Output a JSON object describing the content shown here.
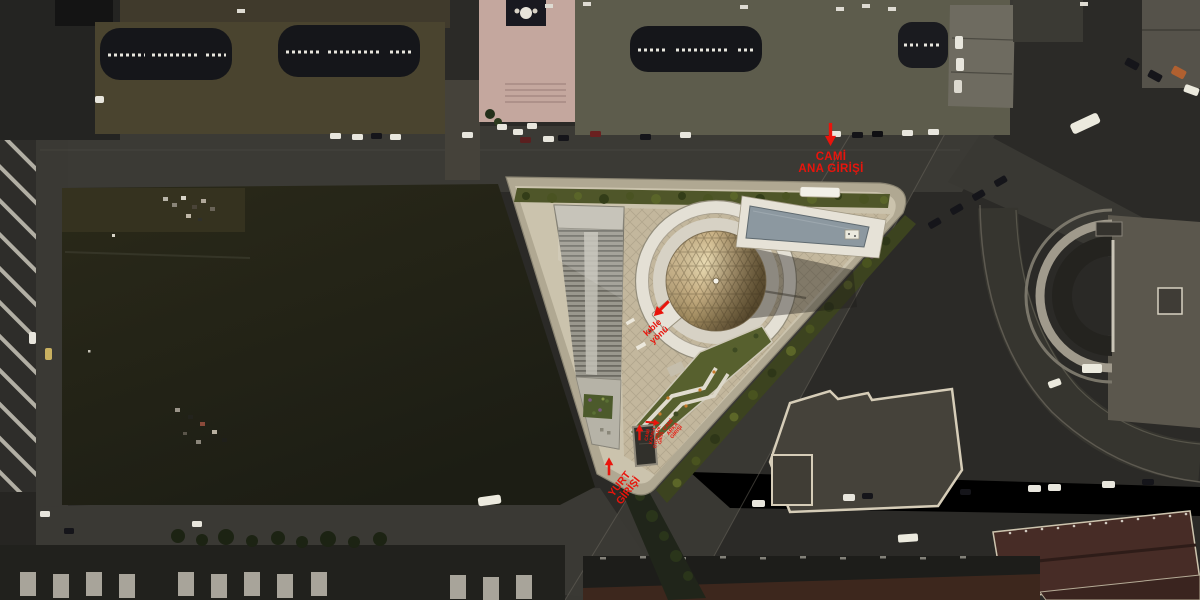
{
  "map": {
    "kind": "satellite-photo-with-architectural-site-plan-overlay",
    "palette": {
      "annotation_red": "#e9140c",
      "site_plaza": "#cbc3ad",
      "dome_bronze": "#b59c6e",
      "pool_slate": "#8c98a0",
      "landscape_green": "#57602e",
      "satellite_base": "#2b2a27",
      "road": "#3a3934"
    },
    "annotations": {
      "cami_ana": {
        "lines": [
          "CAMİ",
          "ANA GİRİŞİ"
        ],
        "icon": "arrow-down-icon"
      },
      "kible": {
        "lines": [
          "kıble",
          "yönü"
        ],
        "icon": "arrow-down-left-icon"
      },
      "otopark": {
        "lines": [
          "CAMİ",
          "KAPALI",
          "OTOPARK",
          "GİRİŞ"
        ],
        "icon": "arrow-up-icon"
      },
      "arka": {
        "lines": [
          "CAMİ",
          "ARKA",
          "GİRİŞİ"
        ],
        "icon": "arrow-right-icon"
      },
      "yurt": {
        "lines": [
          "YURT",
          "GİRİŞİ"
        ],
        "icon": "arrow-up-icon"
      }
    }
  }
}
